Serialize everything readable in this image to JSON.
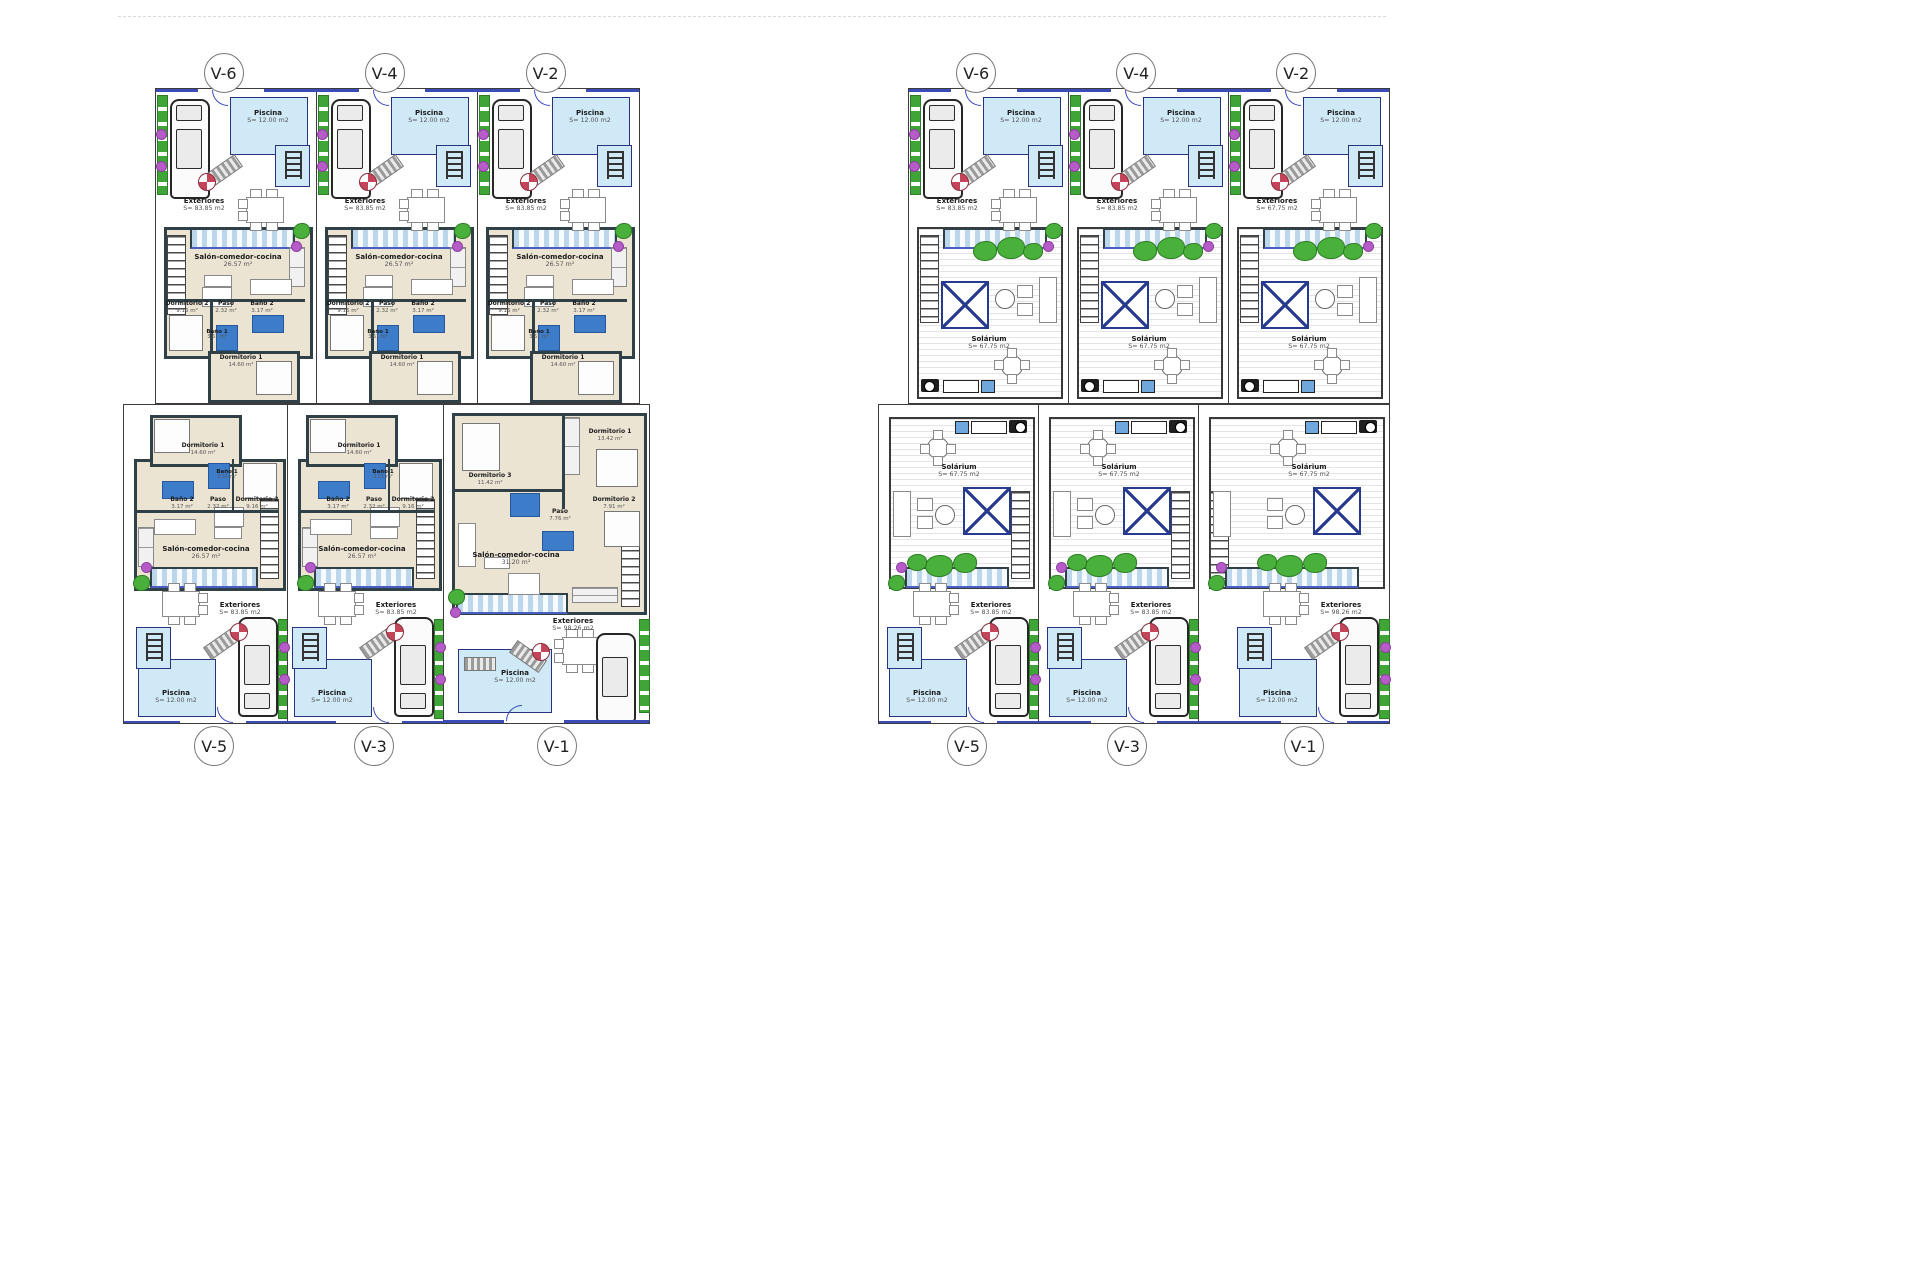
{
  "drawing": {
    "colors": {
      "pool_fill": "#cfe9f6",
      "pool_border": "#27337e",
      "wall_dark": "#2f4147",
      "floor_beige": "#ece4d3",
      "bath_blue": "#3d7cc9",
      "plant_green": "#3fa537",
      "flower_purple": "#b65cc9",
      "accent_blue": "#3b4bb8"
    },
    "sheets": [
      {
        "id": "ground",
        "rows": [
          {
            "units": [
              {
                "label": "V-6",
                "piscina": {
                  "name": "Piscina",
                  "area": "S= 12.00 m2"
                },
                "exteriores": {
                  "name": "Exteriores",
                  "area": "S= 83.85 m2"
                },
                "salon": {
                  "name": "Salón-comedor-cocina",
                  "area": "26.57 m²"
                },
                "paso": {
                  "name": "Paso",
                  "area": "2.32 m²"
                },
                "bano2": {
                  "name": "Baño 2",
                  "area": "3.17 m²"
                },
                "dorm2": {
                  "name": "Dormitorio 2",
                  "area": "9.16 m²"
                },
                "bano1": {
                  "name": "Baño 1",
                  "area": "3.51 m²"
                },
                "dorm1": {
                  "name": "Dormitorio 1",
                  "area": "14.60 m²"
                }
              },
              {
                "label": "V-4",
                "piscina": {
                  "name": "Piscina",
                  "area": "S= 12.00 m2"
                },
                "exteriores": {
                  "name": "Exteriores",
                  "area": "S= 83.85 m2"
                },
                "salon": {
                  "name": "Salón-comedor-cocina",
                  "area": "26.57 m²"
                },
                "paso": {
                  "name": "Paso",
                  "area": "2.32 m²"
                },
                "bano2": {
                  "name": "Baño 2",
                  "area": "3.17 m²"
                },
                "dorm2": {
                  "name": "Dormitorio 2",
                  "area": "9.16 m²"
                },
                "bano1": {
                  "name": "Baño 1",
                  "area": "3.51 m²"
                },
                "dorm1": {
                  "name": "Dormitorio 1",
                  "area": "14.60 m²"
                }
              },
              {
                "label": "V-2",
                "piscina": {
                  "name": "Piscina",
                  "area": "S= 12.00 m2"
                },
                "exteriores": {
                  "name": "Exteriores",
                  "area": "S= 83.85 m2"
                },
                "salon": {
                  "name": "Salón-comedor-cocina",
                  "area": "26.57 m²"
                },
                "paso": {
                  "name": "Paso",
                  "area": "2.32 m²"
                },
                "bano2": {
                  "name": "Baño 2",
                  "area": "3.17 m²"
                },
                "dorm2": {
                  "name": "Dormitorio 2",
                  "area": "9.16 m²"
                },
                "bano1": {
                  "name": "Baño 1",
                  "area": "3.51 m²"
                },
                "dorm1": {
                  "name": "Dormitorio 1",
                  "area": "14.60 m²"
                }
              }
            ]
          },
          {
            "units": [
              {
                "label": "V-5",
                "piscina": {
                  "name": "Piscina",
                  "area": "S= 12.00 m2"
                },
                "exteriores": {
                  "name": "Exteriores",
                  "area": "S= 83.85 m2"
                },
                "salon": {
                  "name": "Salón-comedor-cocina",
                  "area": "26.57 m²"
                },
                "paso": {
                  "name": "Paso",
                  "area": "2.32 m²"
                },
                "bano2": {
                  "name": "Baño 2",
                  "area": "3.17 m²"
                },
                "dorm2": {
                  "name": "Dormitorio 2",
                  "area": "9.16 m²"
                },
                "bano1": {
                  "name": "Baño 1",
                  "area": "3.51 m²"
                },
                "dorm1": {
                  "name": "Dormitorio 1",
                  "area": "14.60 m²"
                }
              },
              {
                "label": "V-3",
                "piscina": {
                  "name": "Piscina",
                  "area": "S= 12.00 m2"
                },
                "exteriores": {
                  "name": "Exteriores",
                  "area": "S= 83.85 m2"
                },
                "salon": {
                  "name": "Salón-comedor-cocina",
                  "area": "26.57 m²"
                },
                "paso": {
                  "name": "Paso",
                  "area": "2.32 m²"
                },
                "bano2": {
                  "name": "Baño 2",
                  "area": "3.17 m²"
                },
                "dorm2": {
                  "name": "Dormitorio 2",
                  "area": "9.16 m²"
                },
                "bano1": {
                  "name": "Baño 1",
                  "area": "3.51 m²"
                },
                "dorm1": {
                  "name": "Dormitorio 1",
                  "area": "14.60 m²"
                }
              },
              {
                "label": "V-1",
                "piscina": {
                  "name": "Piscina",
                  "area": "S= 12.00 m2"
                },
                "exteriores": {
                  "name": "Exteriores",
                  "area": "S= 98.26 m2"
                },
                "salon": {
                  "name": "Salón-comedor-cocina",
                  "area": "31.20 m²"
                },
                "paso": {
                  "name": "Paso",
                  "area": "7.76 m²"
                },
                "dorm1": {
                  "name": "Dormitorio 1",
                  "area": "13.42 m²"
                },
                "dorm2": {
                  "name": "Dormitorio 2",
                  "area": "7.91 m²"
                },
                "dorm3": {
                  "name": "Dormitorio 3",
                  "area": "11.42 m²"
                }
              }
            ]
          }
        ]
      },
      {
        "id": "solarium",
        "rows": [
          {
            "units": [
              {
                "label": "V-6",
                "piscina": {
                  "name": "Piscina",
                  "area": "S= 12.00 m2"
                },
                "exteriores": {
                  "name": "Exteriores",
                  "area": "S= 83.85 m2"
                },
                "solarium": {
                  "name": "Solárium",
                  "area": "S= 67.75 m2"
                }
              },
              {
                "label": "V-4",
                "piscina": {
                  "name": "Piscina",
                  "area": "S= 12.00 m2"
                },
                "exteriores": {
                  "name": "Exteriores",
                  "area": "S= 83.85 m2"
                },
                "solarium": {
                  "name": "Solárium",
                  "area": "S= 67.75 m2"
                }
              },
              {
                "label": "V-2",
                "piscina": {
                  "name": "Piscina",
                  "area": "S= 12.00 m2"
                },
                "exteriores": {
                  "name": "Exteriores",
                  "area": "S= 67.75 m2"
                },
                "solarium": {
                  "name": "Solárium",
                  "area": "S= 67.75 m2"
                }
              }
            ]
          },
          {
            "units": [
              {
                "label": "V-5",
                "piscina": {
                  "name": "Piscina",
                  "area": "S= 12.00 m2"
                },
                "exteriores": {
                  "name": "Exteriores",
                  "area": "S= 83.85 m2"
                },
                "solarium": {
                  "name": "Solárium",
                  "area": "S= 67.75 m2"
                }
              },
              {
                "label": "V-3",
                "piscina": {
                  "name": "Piscina",
                  "area": "S= 12.00 m2"
                },
                "exteriores": {
                  "name": "Exteriores",
                  "area": "S= 83.85 m2"
                },
                "solarium": {
                  "name": "Solárium",
                  "area": "S= 67.75 m2"
                }
              },
              {
                "label": "V-1",
                "piscina": {
                  "name": "Piscina",
                  "area": "S= 12.00 m2"
                },
                "exteriores": {
                  "name": "Exteriores",
                  "area": "S= 98.26 m2"
                },
                "solarium": {
                  "name": "Solárium",
                  "area": "S= 67.75 m2"
                }
              }
            ]
          }
        ]
      }
    ]
  }
}
